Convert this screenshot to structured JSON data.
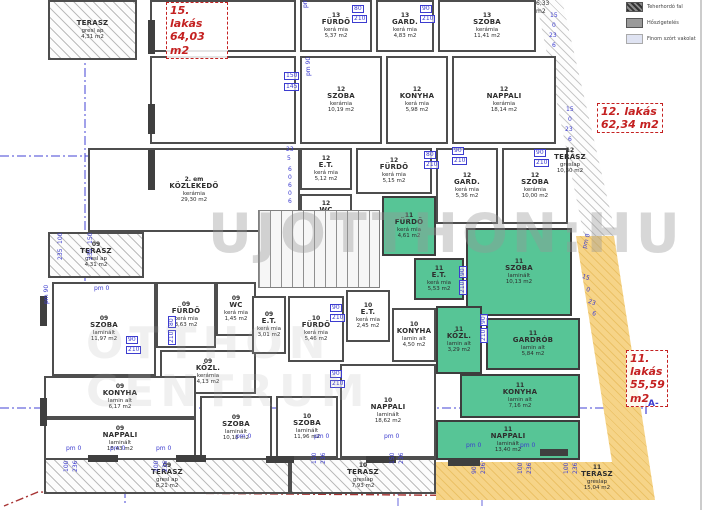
{
  "watermark": {
    "main": "UJOTTHON:HU",
    "line2": "OTTHON",
    "line3": "CENTRUM"
  },
  "section_marker": "A-",
  "legend": {
    "items": [
      {
        "label": "Teherhordó fal",
        "swatch": "wall"
      },
      {
        "label": "Hőszigetelés",
        "swatch": "insulation"
      },
      {
        "label": "Finom szórt vakolat",
        "swatch": "plaster"
      }
    ]
  },
  "apartments": [
    {
      "name": "15. lakás",
      "area": "64,03 m2",
      "x": 166,
      "y": 2,
      "w": 54
    },
    {
      "name": "12. lakás",
      "area": "62,34 m2",
      "x": 597,
      "y": 103,
      "w": 58
    },
    {
      "name": "11. lakás",
      "area": "55,59 m2",
      "x": 626,
      "y": 350,
      "w": 34
    }
  ],
  "rooms": [
    {
      "a": "",
      "n": "TERASZ",
      "m": "gresl ap",
      "s": "4,31 m2",
      "x": 48,
      "y": 0,
      "w": 89,
      "h": 60,
      "k": "hatch"
    },
    {
      "a": "",
      "n": "",
      "m": "",
      "s": "",
      "x": 150,
      "y": 0,
      "w": 146,
      "h": 52,
      "k": "plain"
    },
    {
      "a": "",
      "n": "",
      "m": "",
      "s": "",
      "x": 150,
      "y": 56,
      "w": 146,
      "h": 88,
      "k": "plain"
    },
    {
      "a": "13",
      "n": "FÜRDŐ",
      "m": "kerá mia",
      "s": "5,37 m2",
      "x": 300,
      "y": 0,
      "w": 72,
      "h": 52,
      "k": "plain"
    },
    {
      "a": "13",
      "n": "GARD.",
      "m": "kerá mia",
      "s": "4,83 m2",
      "x": 376,
      "y": 0,
      "w": 58,
      "h": 52,
      "k": "plain"
    },
    {
      "a": "13",
      "n": "SZOBA",
      "m": "kerámia",
      "s": "11,41 m2",
      "x": 438,
      "y": 0,
      "w": 98,
      "h": 52,
      "k": "plain"
    },
    {
      "a": "12",
      "n": "SZOBA",
      "m": "kerámia",
      "s": "10,19 m2",
      "x": 300,
      "y": 56,
      "w": 82,
      "h": 88,
      "k": "plain"
    },
    {
      "a": "12",
      "n": "KONYHA",
      "m": "kerá mia",
      "s": "5,98 m2",
      "x": 386,
      "y": 56,
      "w": 62,
      "h": 88,
      "k": "plain"
    },
    {
      "a": "12",
      "n": "NAPPALI",
      "m": "kerámia",
      "s": "18,14 m2",
      "x": 452,
      "y": 56,
      "w": 104,
      "h": 88,
      "k": "plain"
    },
    {
      "a": "2. em",
      "n": "KÖZLEKEDŐ",
      "m": "kerámia",
      "s": "29,30 m2",
      "x": 88,
      "y": 148,
      "w": 212,
      "h": 84,
      "k": "plain"
    },
    {
      "a": "12",
      "n": "E.T.",
      "m": "kerá mia",
      "s": "5,12 m2",
      "x": 300,
      "y": 148,
      "w": 52,
      "h": 42,
      "k": "plain"
    },
    {
      "a": "12",
      "n": "WC",
      "m": "kerá mia",
      "s": "2,40 m2",
      "x": 300,
      "y": 194,
      "w": 52,
      "h": 40,
      "k": "plain"
    },
    {
      "a": "12",
      "n": "FÜRDŐ",
      "m": "kerá mia",
      "s": "5,15 m2",
      "x": 356,
      "y": 148,
      "w": 76,
      "h": 46,
      "k": "plain"
    },
    {
      "a": "12",
      "n": "GARD.",
      "m": "kerá mia",
      "s": "5,36 m2",
      "x": 436,
      "y": 148,
      "w": 62,
      "h": 76,
      "k": "plain"
    },
    {
      "a": "12",
      "n": "SZOBA",
      "m": "kerámia",
      "s": "10,00 m2",
      "x": 502,
      "y": 148,
      "w": 66,
      "h": 76,
      "k": "plain"
    },
    {
      "a": "11",
      "n": "FÜRDŐ",
      "m": "kerá mia",
      "s": "4,61 m2",
      "x": 382,
      "y": 196,
      "w": 54,
      "h": 60,
      "k": "green"
    },
    {
      "a": "11",
      "n": "E.T.",
      "m": "kerá mia",
      "s": "5,53 m2",
      "x": 414,
      "y": 258,
      "w": 50,
      "h": 42,
      "k": "green"
    },
    {
      "a": "11",
      "n": "SZOBA",
      "m": "laminált",
      "s": "10,13 m2",
      "x": 466,
      "y": 228,
      "w": 106,
      "h": 88,
      "k": "green"
    },
    {
      "a": "11",
      "n": "KÖZL.",
      "m": "lamin alt",
      "s": "3,29 m2",
      "x": 436,
      "y": 306,
      "w": 46,
      "h": 68,
      "k": "green"
    },
    {
      "a": "11",
      "n": "GARDRÓB",
      "m": "lamin alt",
      "s": "5,84 m2",
      "x": 486,
      "y": 318,
      "w": 94,
      "h": 52,
      "k": "green"
    },
    {
      "a": "11",
      "n": "KONYHA",
      "m": "lamin alt",
      "s": "7,16 m2",
      "x": 460,
      "y": 374,
      "w": 120,
      "h": 44,
      "k": "green"
    },
    {
      "a": "11",
      "n": "NAPPALI",
      "m": "laminált",
      "s": "13,40 m2",
      "x": 436,
      "y": 420,
      "w": 144,
      "h": 40,
      "k": "green"
    },
    {
      "a": "12",
      "n": "TERASZ",
      "m": "greslap",
      "s": "10,30 m2",
      "x": 544,
      "y": 140,
      "w": 52,
      "h": 42,
      "k": "label"
    },
    {
      "a": "11",
      "n": "TERASZ",
      "m": "greslap",
      "s": "15,04 m2",
      "x": 568,
      "y": 460,
      "w": 58,
      "h": 36,
      "k": "label"
    },
    {
      "a": "09",
      "n": "TERASZ",
      "m": "gresl ap",
      "s": "4,31 m2",
      "x": 48,
      "y": 232,
      "w": 96,
      "h": 46,
      "k": "hatch"
    },
    {
      "a": "09",
      "n": "SZOBA",
      "m": "laminált",
      "s": "11,97 m2",
      "x": 52,
      "y": 282,
      "w": 104,
      "h": 94,
      "k": "plain"
    },
    {
      "a": "09",
      "n": "FÜRDŐ",
      "m": "kerá mia",
      "s": "3,63 m2",
      "x": 156,
      "y": 282,
      "w": 60,
      "h": 66,
      "k": "plain"
    },
    {
      "a": "09",
      "n": "WC",
      "m": "kerá mia",
      "s": "1,45 m2",
      "x": 216,
      "y": 282,
      "w": 40,
      "h": 54,
      "k": "plain"
    },
    {
      "a": "09",
      "n": "KÖZL.",
      "m": "kerámia",
      "s": "4,13 m2",
      "x": 160,
      "y": 350,
      "w": 96,
      "h": 44,
      "k": "plain"
    },
    {
      "a": "09",
      "n": "E.T.",
      "m": "kerá mia",
      "s": "3,01 m2",
      "x": 252,
      "y": 296,
      "w": 34,
      "h": 58,
      "k": "plain"
    },
    {
      "a": "09",
      "n": "KONYHA",
      "m": "lamin alt",
      "s": "6,17 m2",
      "x": 44,
      "y": 376,
      "w": 152,
      "h": 42,
      "k": "plain"
    },
    {
      "a": "09",
      "n": "NAPPALI",
      "m": "laminált",
      "s": "18,43 m2",
      "x": 44,
      "y": 418,
      "w": 152,
      "h": 42,
      "k": "plain"
    },
    {
      "a": "09",
      "n": "SZOBA",
      "m": "laminált",
      "s": "10,18 m2",
      "x": 200,
      "y": 396,
      "w": 72,
      "h": 64,
      "k": "plain"
    },
    {
      "a": "10",
      "n": "FÜRDŐ",
      "m": "kerá mia",
      "s": "5,46 m2",
      "x": 288,
      "y": 296,
      "w": 56,
      "h": 66,
      "k": "plain"
    },
    {
      "a": "10",
      "n": "E.T.",
      "m": "kerá mia",
      "s": "2,45 m2",
      "x": 346,
      "y": 290,
      "w": 44,
      "h": 52,
      "k": "plain"
    },
    {
      "a": "10",
      "n": "KONYHA",
      "m": "lamin alt",
      "s": "4,50 m2",
      "x": 392,
      "y": 308,
      "w": 44,
      "h": 54,
      "k": "plain"
    },
    {
      "a": "10",
      "n": "NAPPALI",
      "m": "laminált",
      "s": "18,62 m2",
      "x": 340,
      "y": 364,
      "w": 96,
      "h": 94,
      "k": "plain"
    },
    {
      "a": "10",
      "n": "SZOBA",
      "m": "laminált",
      "s": "11,96 m2",
      "x": 276,
      "y": 396,
      "w": 62,
      "h": 62,
      "k": "plain"
    },
    {
      "a": "09",
      "n": "TERASZ",
      "m": "gresl ap",
      "s": "8,21 m2",
      "x": 44,
      "y": 458,
      "w": 246,
      "h": 36,
      "k": "hatch"
    },
    {
      "a": "10",
      "n": "TERASZ",
      "m": "greslap",
      "s": "7,93 m2",
      "x": 290,
      "y": 458,
      "w": 146,
      "h": 36,
      "k": "hatch"
    }
  ],
  "stairs": {
    "x": 258,
    "y": 210,
    "w": 120,
    "h": 76
  },
  "dims": [
    [
      352,
      5,
      "80",
      0,
      1
    ],
    [
      352,
      15,
      "210",
      0,
      1
    ],
    [
      420,
      5,
      "90",
      0,
      1
    ],
    [
      420,
      15,
      "210",
      0,
      1
    ],
    [
      284,
      72,
      "150",
      0,
      1
    ],
    [
      284,
      83,
      "145",
      0,
      1
    ],
    [
      303,
      8,
      "pm 1,70",
      -90,
      0
    ],
    [
      306,
      76,
      "pm 90",
      -90,
      0
    ],
    [
      550,
      13,
      "15"
    ],
    [
      552,
      23,
      "0"
    ],
    [
      549,
      33,
      "23"
    ],
    [
      552,
      43,
      "6"
    ],
    [
      566,
      107,
      "15"
    ],
    [
      568,
      117,
      "0"
    ],
    [
      565,
      127,
      "23"
    ],
    [
      568,
      137,
      "6"
    ],
    [
      583,
      274,
      "15",
      18
    ],
    [
      587,
      287,
      "0",
      18
    ],
    [
      589,
      299,
      "23",
      18
    ],
    [
      593,
      311,
      "6",
      18
    ],
    [
      286,
      147,
      "23"
    ],
    [
      287,
      156,
      "5"
    ],
    [
      288,
      167,
      "6"
    ],
    [
      288,
      175,
      "0"
    ],
    [
      288,
      183,
      "6"
    ],
    [
      288,
      191,
      "0"
    ],
    [
      288,
      199,
      "6"
    ],
    [
      424,
      151,
      "80",
      0,
      1
    ],
    [
      424,
      161,
      "210",
      0,
      1
    ],
    [
      452,
      147,
      "90",
      0,
      1
    ],
    [
      452,
      157,
      "210",
      0,
      1
    ],
    [
      534,
      149,
      "90",
      0,
      1
    ],
    [
      534,
      159,
      "210",
      0,
      1
    ],
    [
      459,
      278,
      "90",
      -90,
      1
    ],
    [
      459,
      295,
      "210",
      -90,
      1
    ],
    [
      480,
      326,
      "90",
      -90,
      1
    ],
    [
      480,
      343,
      "210",
      -90,
      1
    ],
    [
      126,
      336,
      "90",
      0,
      1
    ],
    [
      126,
      346,
      "210",
      0,
      1
    ],
    [
      168,
      328,
      "80",
      -90,
      1
    ],
    [
      168,
      345,
      "210",
      -90,
      1
    ],
    [
      330,
      304,
      "90",
      0,
      1
    ],
    [
      330,
      314,
      "210",
      0,
      1
    ],
    [
      330,
      370,
      "90",
      0,
      1
    ],
    [
      330,
      380,
      "210",
      0,
      1
    ],
    [
      58,
      244,
      "100",
      -90
    ],
    [
      58,
      260,
      "235",
      -90
    ],
    [
      88,
      244,
      "150",
      -90
    ],
    [
      88,
      260,
      "235",
      -90
    ],
    [
      44,
      304,
      "pm 90",
      -90
    ],
    [
      94,
      286,
      "pm 0"
    ],
    [
      66,
      446,
      "pm 0"
    ],
    [
      110,
      446,
      "pm 0"
    ],
    [
      156,
      446,
      "pm 0"
    ],
    [
      236,
      434,
      "pm 0"
    ],
    [
      314,
      434,
      "pm 0"
    ],
    [
      384,
      434,
      "pm 0"
    ],
    [
      466,
      443,
      "pm 0"
    ],
    [
      520,
      443,
      "pm 0"
    ],
    [
      582,
      248,
      "pm 0",
      -75
    ],
    [
      64,
      472,
      "100",
      -90
    ],
    [
      73,
      472,
      "236",
      -90
    ],
    [
      154,
      472,
      "100",
      -90
    ],
    [
      163,
      472,
      "236",
      -90
    ],
    [
      312,
      464,
      "150",
      -90
    ],
    [
      321,
      464,
      "236",
      -90
    ],
    [
      390,
      464,
      "150",
      -90
    ],
    [
      399,
      464,
      "236",
      -90
    ],
    [
      472,
      474,
      "90",
      -90
    ],
    [
      481,
      474,
      "236",
      -90
    ],
    [
      518,
      474,
      "100",
      -90
    ],
    [
      527,
      474,
      "236",
      -90
    ],
    [
      564,
      474,
      "100",
      -90
    ],
    [
      573,
      474,
      "236",
      -90
    ],
    [
      536,
      1,
      "6,33",
      0,
      0,
      1
    ],
    [
      536,
      9,
      "m2",
      0,
      0,
      1
    ]
  ],
  "wall_marks": [
    [
      148,
      20,
      7,
      34
    ],
    [
      148,
      104,
      7,
      30
    ],
    [
      148,
      150,
      7,
      40
    ],
    [
      40,
      296,
      7,
      30
    ],
    [
      40,
      398,
      7,
      28
    ],
    [
      88,
      455,
      30,
      7
    ],
    [
      176,
      455,
      30,
      7
    ],
    [
      266,
      456,
      28,
      7
    ],
    [
      366,
      456,
      30,
      7
    ],
    [
      448,
      459,
      32,
      7
    ],
    [
      540,
      449,
      28,
      7
    ]
  ]
}
